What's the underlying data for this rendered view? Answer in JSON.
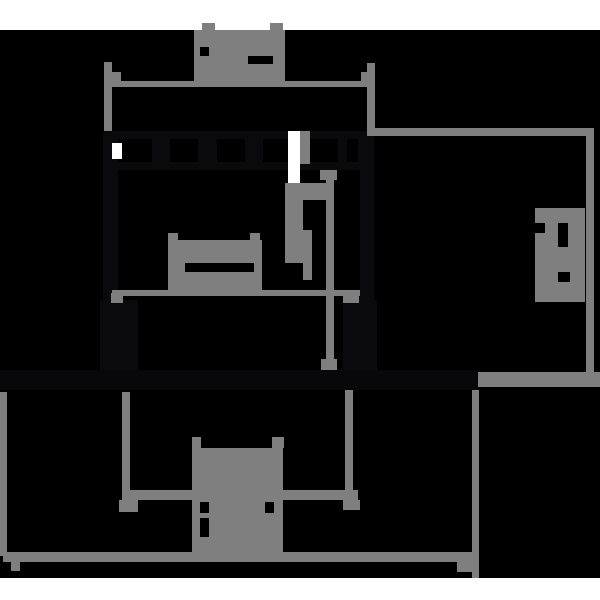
{
  "figure": {
    "kind": "technical-dimension-drawing",
    "appearance": "inverted dark rendering of a DIN-rail mounted component outline drawing",
    "canvas": {
      "width": 600,
      "height": 600
    },
    "labels_note": "all dimension text is greeked (rendered as illegible gray blocks with black marks), no readable characters are present in the pixels"
  },
  "palette": {
    "background": "#000000",
    "page_band": "#ffffff",
    "dimension_gray": "#7f7f7f",
    "part_dark": "#0a0a0d",
    "rail_dark": "#08080a",
    "label_mark_black": "#000000"
  },
  "shapes": [
    {
      "name": "page-band-top",
      "role": "band",
      "x": 0,
      "y": 0,
      "w": 600,
      "h": 30
    },
    {
      "name": "page-band-bottom",
      "role": "band",
      "x": 0,
      "y": 578,
      "w": 600,
      "h": 22
    },
    {
      "name": "part-top-edge",
      "role": "part",
      "x": 103,
      "y": 131,
      "w": 271,
      "h": 8
    },
    {
      "name": "part-castellation-bottom-edge",
      "role": "part",
      "x": 103,
      "y": 162,
      "w": 271,
      "h": 8
    },
    {
      "name": "part-castellation-wall-1",
      "role": "part",
      "x": 152,
      "y": 139,
      "w": 18,
      "h": 31
    },
    {
      "name": "part-castellation-wall-2",
      "role": "part",
      "x": 198,
      "y": 139,
      "w": 19,
      "h": 31
    },
    {
      "name": "part-castellation-wall-3",
      "role": "part",
      "x": 245,
      "y": 139,
      "w": 18,
      "h": 31
    },
    {
      "name": "part-castellation-wall-4",
      "role": "part",
      "x": 338,
      "y": 139,
      "w": 9,
      "h": 31
    },
    {
      "name": "part-castellation-wall-5",
      "role": "part",
      "x": 358,
      "y": 139,
      "w": 8,
      "h": 31
    },
    {
      "name": "part-left-edge",
      "role": "part",
      "x": 103,
      "y": 131,
      "w": 15,
      "h": 241
    },
    {
      "name": "part-right-edge",
      "role": "part",
      "x": 360,
      "y": 131,
      "w": 14,
      "h": 241
    },
    {
      "name": "part-left-foot",
      "role": "part",
      "x": 100,
      "y": 300,
      "w": 38,
      "h": 72
    },
    {
      "name": "part-right-foot",
      "role": "part",
      "x": 343,
      "y": 300,
      "w": 34,
      "h": 72
    },
    {
      "name": "din-rail-band",
      "role": "rail",
      "x": 0,
      "y": 370,
      "w": 478,
      "h": 20
    },
    {
      "name": "terminal-slot-white-left",
      "role": "band",
      "x": 112,
      "y": 143,
      "w": 10,
      "h": 16
    },
    {
      "name": "terminal-slot-white-right",
      "role": "band",
      "x": 288,
      "y": 131,
      "w": 12,
      "h": 56
    },
    {
      "name": "terminal-slot-gray-right",
      "role": "dim",
      "x": 300,
      "y": 131,
      "w": 10,
      "h": 33
    },
    {
      "name": "top-dimension-extension-left",
      "role": "dim",
      "x": 104,
      "y": 62,
      "w": 8,
      "h": 69
    },
    {
      "name": "top-dimension-extension-right",
      "role": "dim",
      "x": 367,
      "y": 63,
      "w": 8,
      "h": 73
    },
    {
      "name": "top-dimension-line",
      "role": "dim",
      "x": 112,
      "y": 81,
      "w": 263,
      "h": 6
    },
    {
      "name": "top-dimension-tick-left",
      "role": "dim",
      "x": 112,
      "y": 72,
      "w": 9,
      "h": 9
    },
    {
      "name": "top-dimension-tick-right",
      "role": "dim",
      "x": 361,
      "y": 72,
      "w": 9,
      "h": 10
    },
    {
      "name": "top-dimension-label-blob",
      "role": "dim",
      "x": 194,
      "y": 30,
      "w": 91,
      "h": 53
    },
    {
      "name": "top-dimension-label-tab-left",
      "role": "dim",
      "x": 202,
      "y": 23,
      "w": 13,
      "h": 8
    },
    {
      "name": "top-dimension-label-tab-right",
      "role": "dim",
      "x": 270,
      "y": 23,
      "w": 13,
      "h": 8
    },
    {
      "name": "top-dimension-label-mark-1",
      "role": "mark",
      "x": 200,
      "y": 47,
      "w": 9,
      "h": 9
    },
    {
      "name": "top-dimension-label-mark-2",
      "role": "mark",
      "x": 248,
      "y": 56,
      "w": 25,
      "h": 8
    },
    {
      "name": "mid-dimension-line",
      "role": "dim",
      "x": 112,
      "y": 290,
      "w": 248,
      "h": 6
    },
    {
      "name": "mid-dimension-tick-left",
      "role": "dim",
      "x": 111,
      "y": 293,
      "w": 12,
      "h": 10
    },
    {
      "name": "mid-dimension-tick-right",
      "role": "dim",
      "x": 343,
      "y": 294,
      "w": 16,
      "h": 9
    },
    {
      "name": "mid-dimension-label-blob",
      "role": "dim",
      "x": 168,
      "y": 240,
      "w": 94,
      "h": 51
    },
    {
      "name": "mid-dimension-label-tab-left",
      "role": "dim",
      "x": 168,
      "y": 233,
      "w": 10,
      "h": 7
    },
    {
      "name": "mid-dimension-label-tab-right",
      "role": "dim",
      "x": 250,
      "y": 233,
      "w": 10,
      "h": 7
    },
    {
      "name": "mid-dimension-label-mark",
      "role": "mark",
      "x": 185,
      "y": 263,
      "w": 69,
      "h": 9
    },
    {
      "name": "vertical-dimension-line",
      "role": "dim",
      "x": 326,
      "y": 173,
      "w": 8,
      "h": 197
    },
    {
      "name": "vertical-dimension-tick-top",
      "role": "dim",
      "x": 320,
      "y": 170,
      "w": 17,
      "h": 10
    },
    {
      "name": "vertical-dimension-tick-bottom",
      "role": "dim",
      "x": 321,
      "y": 359,
      "w": 16,
      "h": 11
    },
    {
      "name": "vertical-dimension-label-blob-a",
      "role": "dim",
      "x": 285,
      "y": 183,
      "w": 41,
      "h": 17
    },
    {
      "name": "vertical-dimension-label-blob-b",
      "role": "dim",
      "x": 285,
      "y": 200,
      "w": 18,
      "h": 30
    },
    {
      "name": "vertical-dimension-label-blob-c",
      "role": "dim",
      "x": 285,
      "y": 230,
      "w": 27,
      "h": 33
    },
    {
      "name": "vertical-dimension-label-blob-d",
      "role": "dim",
      "x": 303,
      "y": 263,
      "w": 9,
      "h": 17
    },
    {
      "name": "right-dimension-top-line",
      "role": "dim",
      "x": 368,
      "y": 128,
      "w": 226,
      "h": 8
    },
    {
      "name": "right-dimension-vertical-line",
      "role": "dim",
      "x": 586,
      "y": 128,
      "w": 8,
      "h": 249
    },
    {
      "name": "right-dimension-rail-reference",
      "role": "dim",
      "x": 478,
      "y": 372,
      "w": 122,
      "h": 15
    },
    {
      "name": "right-dimension-label-blob",
      "role": "dim",
      "x": 535,
      "y": 208,
      "w": 50,
      "h": 94
    },
    {
      "name": "right-dimension-label-mark-1",
      "role": "mark",
      "x": 535,
      "y": 223,
      "w": 10,
      "h": 10
    },
    {
      "name": "right-dimension-label-mark-2",
      "role": "mark",
      "x": 558,
      "y": 223,
      "w": 10,
      "h": 24
    },
    {
      "name": "right-dimension-label-mark-3",
      "role": "mark",
      "x": 558,
      "y": 272,
      "w": 12,
      "h": 10
    },
    {
      "name": "bottom-dimension-extension-left",
      "role": "dim",
      "x": 122,
      "y": 392,
      "w": 8,
      "h": 108
    },
    {
      "name": "bottom-dimension-extension-left-tick",
      "role": "dim",
      "x": 119,
      "y": 500,
      "w": 19,
      "h": 12
    },
    {
      "name": "bottom-dimension-extension-right",
      "role": "dim",
      "x": 345,
      "y": 390,
      "w": 8,
      "h": 110
    },
    {
      "name": "bottom-dimension-extension-right-tick",
      "role": "dim",
      "x": 343,
      "y": 500,
      "w": 17,
      "h": 10
    },
    {
      "name": "bottom-dimension-line",
      "role": "dim",
      "x": 122,
      "y": 490,
      "w": 236,
      "h": 10
    },
    {
      "name": "bottom-dimension-label-tab-left",
      "role": "dim",
      "x": 192,
      "y": 437,
      "w": 9,
      "h": 11
    },
    {
      "name": "bottom-dimension-label-tab-right",
      "role": "dim",
      "x": 272,
      "y": 437,
      "w": 12,
      "h": 11
    },
    {
      "name": "bottom-dimension-label-blob",
      "role": "dim",
      "x": 192,
      "y": 448,
      "w": 91,
      "h": 112
    },
    {
      "name": "bottom-dimension-label-mark-1",
      "role": "mark",
      "x": 200,
      "y": 502,
      "w": 9,
      "h": 11
    },
    {
      "name": "bottom-dimension-label-mark-2",
      "role": "mark",
      "x": 200,
      "y": 518,
      "w": 9,
      "h": 19
    },
    {
      "name": "bottom-dimension-label-mark-3",
      "role": "mark",
      "x": 265,
      "y": 502,
      "w": 9,
      "h": 11
    },
    {
      "name": "rail-dimension-extension-left",
      "role": "dim",
      "x": 0,
      "y": 392,
      "w": 7,
      "h": 164
    },
    {
      "name": "rail-dimension-extension-right",
      "role": "dim",
      "x": 472,
      "y": 390,
      "w": 7,
      "h": 188
    },
    {
      "name": "rail-dimension-line",
      "role": "dim",
      "x": 3,
      "y": 552,
      "w": 475,
      "h": 10
    },
    {
      "name": "rail-dimension-tick-left",
      "role": "dim",
      "x": 11,
      "y": 562,
      "w": 9,
      "h": 9
    },
    {
      "name": "rail-dimension-tick-right",
      "role": "dim",
      "x": 457,
      "y": 562,
      "w": 21,
      "h": 10
    }
  ]
}
